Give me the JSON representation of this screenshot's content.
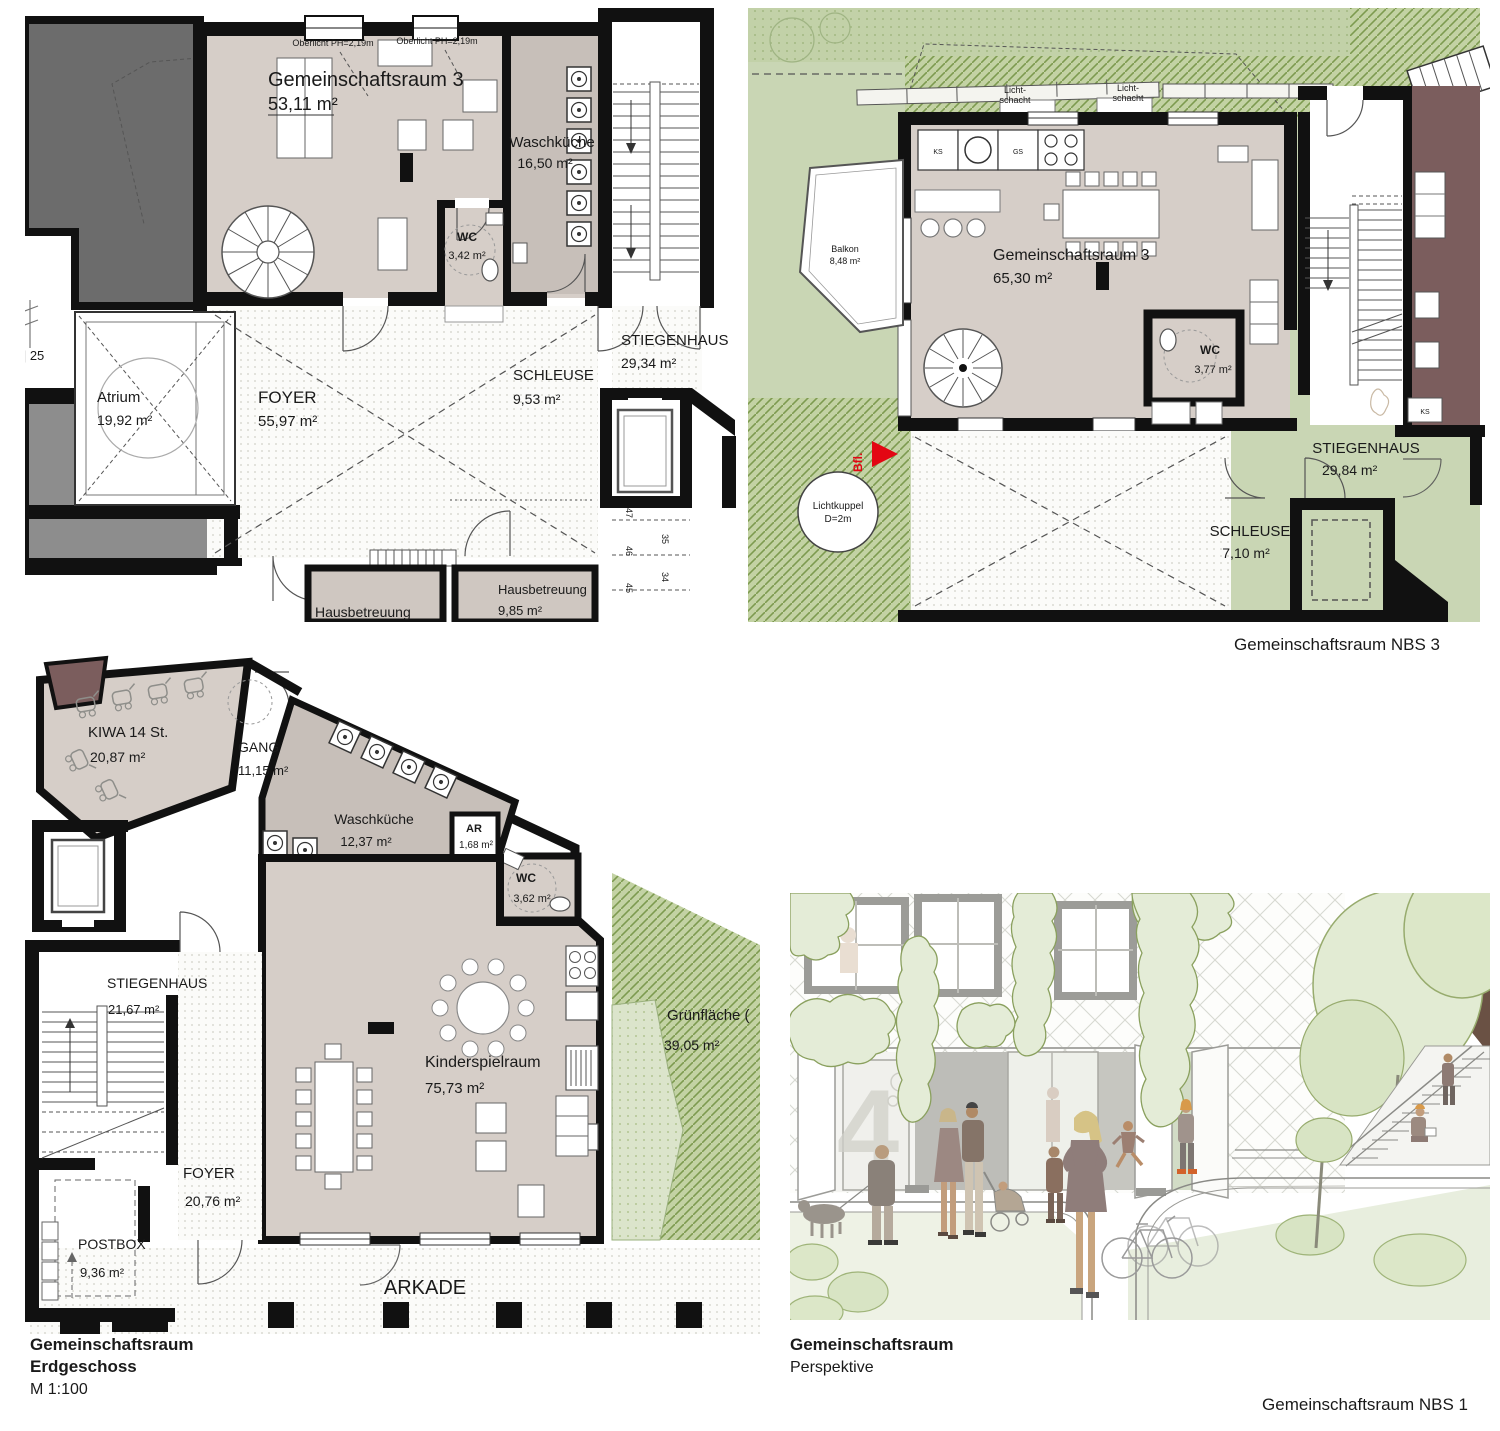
{
  "colors": {
    "wall": "#111111",
    "room_fill": "#d6cec8",
    "room_fill_dark": "#c7bfb9",
    "green_base": "#c9d6b4",
    "green_hatch_line": "#7d9a50",
    "maroon_wall": "#7b5d5d",
    "neighbor_gray": "#6c6c6c",
    "accent_red": "#e30613"
  },
  "plan_regelgeschoss": {
    "oberlicht_a": "Oberlicht PH=2,19m",
    "oberlicht_b": "Oberlicht PH=2,19m",
    "gemeinschaftsraum": {
      "name": "Gemeinschaftsraum 3",
      "area": "53,11 m²"
    },
    "waschkueche": {
      "name": "Waschküche",
      "area": "16,50 m²"
    },
    "wc": {
      "name": "WC",
      "area": "3,42 m²"
    },
    "atrium": {
      "name": "Atrium",
      "area": "19,92 m²"
    },
    "foyer": {
      "name": "FOYER",
      "area": "55,97 m²"
    },
    "schleuse": {
      "name": "SCHLEUSE",
      "area": "9,53 m²"
    },
    "stiegenhaus": {
      "name": "STIEGENHAUS",
      "area": "29,34 m²"
    },
    "hausbetreuung": {
      "name": "Hausbetreuung",
      "area": "9,85 m²"
    },
    "dimension_note": "5 | 25",
    "stair_numbers": [
      "47",
      "46",
      "45",
      "35",
      "34"
    ]
  },
  "plan_nbs3": {
    "lichtschacht_line1": "Licht-",
    "lichtschacht_line2": "schacht",
    "kitchen": {
      "ks": "KS",
      "gs": "GS"
    },
    "balkon": {
      "name": "Balkon",
      "area": "8,48 m²"
    },
    "gemeinschaftsraum": {
      "name": "Gemeinschaftsraum 3",
      "area": "65,30 m²"
    },
    "wc": {
      "name": "WC",
      "area": "3,77 m²"
    },
    "stiegenhaus": {
      "name": "STIEGENHAUS",
      "area": "29,84 m²"
    },
    "schleuse": {
      "name": "SCHLEUSE",
      "area": "7,10 m²"
    },
    "lichtkuppel_line1": "Lichtkuppel",
    "lichtkuppel_line2": "D=2m",
    "bfl": "Bfl.",
    "ks_neighbor": "KS"
  },
  "plan_erdgeschoss": {
    "kiwa": {
      "name": "KIWA 14 St.",
      "area": "20,87 m²"
    },
    "gang": {
      "name": "GANG",
      "area": "11,15 m²"
    },
    "waschkueche": {
      "name": "Waschküche",
      "area": "12,37 m²"
    },
    "ar": {
      "name": "AR",
      "area": "1,68 m²"
    },
    "wc": {
      "name": "WC",
      "area": "3,62 m²"
    },
    "stiegenhaus": {
      "name": "STIEGENHAUS",
      "area": "21,67 m²"
    },
    "kinderspielraum": {
      "name": "Kinderspielraum",
      "area": "75,73 m²"
    },
    "gruenflaeche": {
      "name": "Grünfläche (",
      "area": "39,05 m²"
    },
    "foyer": {
      "name": "FOYER",
      "area": "20,76 m²"
    },
    "postbox": {
      "name": "POSTBOX",
      "area": "9,36 m²"
    },
    "arkade": "ARKADE"
  },
  "perspective": {
    "door_number": "4"
  },
  "captions": {
    "nbs3": "Gemeinschaftsraum NBS 3",
    "eg_title": "Gemeinschaftsraum",
    "eg_floor": "Erdgeschoss",
    "eg_scale": "M 1:100",
    "persp_title": "Gemeinschaftsraum",
    "persp_sub": "Perspektive",
    "nbs1": "Gemeinschaftsraum NBS 1"
  }
}
